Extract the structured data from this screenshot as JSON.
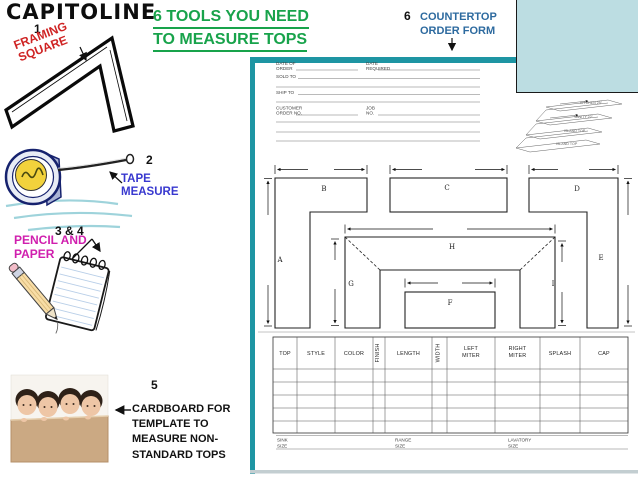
{
  "logo": {
    "text": "CAPITOLINE"
  },
  "title": {
    "line1": "6 TOOLS YOU NEED",
    "line2": "TO MEASURE TOPS"
  },
  "tools": {
    "framing_square": {
      "number": "1",
      "label1": "FRAMING",
      "label2": "SQUARE"
    },
    "tape_measure": {
      "number": "2",
      "label1": "TAPE",
      "label2": "MEASURE"
    },
    "pencil_paper": {
      "number": "3 & 4",
      "label1": "PENCIL AND",
      "label2": "PAPER"
    },
    "cardboard": {
      "number": "5",
      "line1": "CARDBOARD FOR",
      "line2": "TEMPLATE TO",
      "line3": "MEASURE NON-",
      "line4": "STANDARD TOPS"
    },
    "order_form": {
      "number": "6",
      "label1": "COUNTERTOP",
      "label2": "ORDER FORM"
    }
  },
  "form": {
    "header_fields": {
      "date_of_order1": "DATE OF",
      "date_of_order2": "ORDER",
      "date_required1": "DATE",
      "date_required2": "REQUIRED",
      "sold_to": "SOLD TO",
      "ship_to": "SHIP TO",
      "customer1": "CUSTOMER",
      "customer2": "ORDER NO.",
      "job1": "JOB",
      "job2": "NO."
    },
    "sketch_labels": [
      "KITCHEN 25\"",
      "VANITY 22\"",
      "ISLAND TOP",
      "ISLAND TOP"
    ],
    "diagram_labels": [
      "A",
      "B",
      "C",
      "D",
      "E",
      "F",
      "G",
      "H",
      "I"
    ],
    "table_headers": [
      {
        "l1": "TOP"
      },
      {
        "l1": "STYLE"
      },
      {
        "l1": "COLOR"
      },
      {
        "l1": "FINISH"
      },
      {
        "l1": "LENGTH"
      },
      {
        "l1": "WIDTH"
      },
      {
        "l1": "LEFT",
        "l2": "MITER"
      },
      {
        "l1": "RIGHT",
        "l2": "MITER"
      },
      {
        "l1": "SPLASH"
      },
      {
        "l1": "CAP"
      }
    ],
    "size_fields": [
      {
        "l1": "SINK",
        "l2": "SIZE"
      },
      {
        "l1": "RANGE",
        "l2": "SIZE"
      },
      {
        "l1": "LAVATORY",
        "l2": "SIZE"
      }
    ]
  },
  "colors": {
    "teal": "#1e95a3",
    "panel_blue": "#bcdde2",
    "title_green": "#18a34b",
    "red": "#cf2424",
    "blue": "#3838cf",
    "magenta": "#d01fae",
    "steel_blue": "#2d6a9f"
  }
}
